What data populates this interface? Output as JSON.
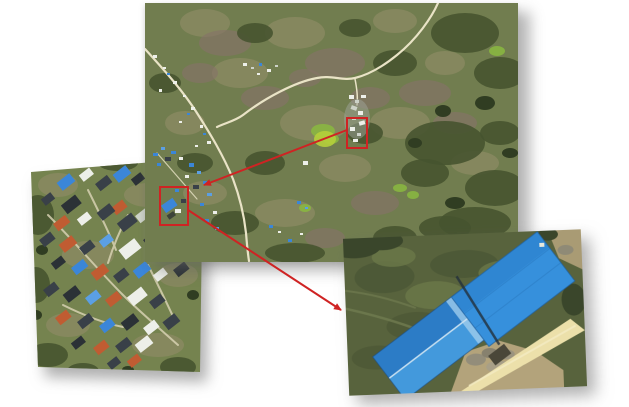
{
  "figure": {
    "type": "annotated-aerial-figure",
    "panels": {
      "overview": {
        "label": "overview-aerial-photo"
      },
      "village_inset": {
        "label": "village-closeup-photo"
      },
      "warehouse_inset": {
        "label": "blue-warehouse-closeup-photo"
      }
    },
    "annotations": {
      "highlight_color": "#cf2323"
    },
    "colors": {
      "page_bg": "#ffffff",
      "terrain": "#717d4f",
      "village_terrain": "#75834f",
      "field_terrain": "#58633d",
      "road": "#e9e3c6",
      "village_path": "#d8d2b2",
      "roof_blue": "#3b86d8",
      "roof_orange": "#c05c32",
      "roof_slate": "#394048",
      "roof_white": "#e9ebe7",
      "warehouse_blue_dark": "#2c7cc6",
      "warehouse_blue_mid": "#4399dc",
      "warehouse_blue_right": "#3690dc",
      "dirt": "#b3a37b",
      "sand_road": "#ece0aa"
    }
  }
}
